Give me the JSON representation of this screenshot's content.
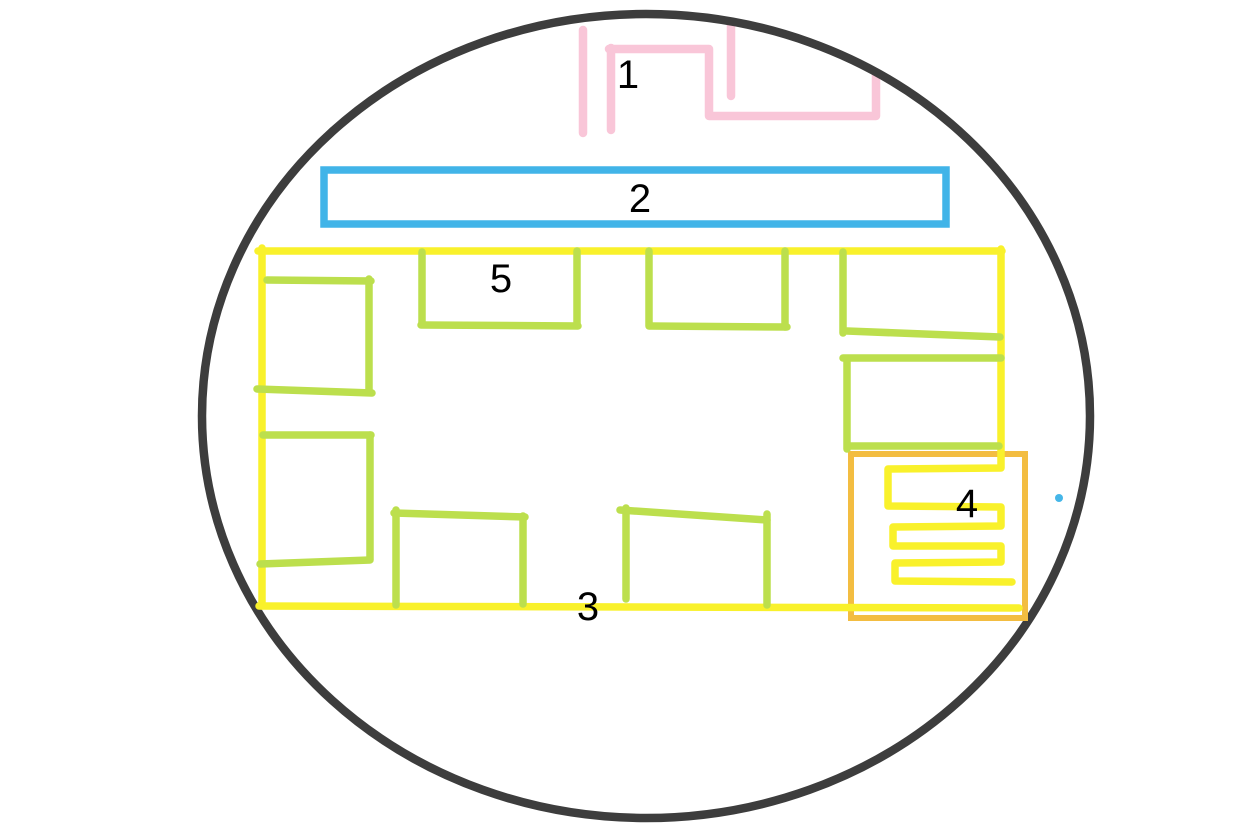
{
  "canvas": {
    "width": 1236,
    "height": 837,
    "background": "#ffffff"
  },
  "palette": {
    "outline_gray": "#3d3d3d",
    "pink": "#f9c6d8",
    "blue": "#41b4e8",
    "yellow": "#f9f12b",
    "green": "#bcdf4d",
    "orange": "#f3bd41",
    "dot_blue": "#45b6e8",
    "label_color": "#000000"
  },
  "labels": [
    {
      "id": "1",
      "text": "1",
      "x": 628,
      "y": 75
    },
    {
      "id": "2",
      "text": "2",
      "x": 640,
      "y": 199
    },
    {
      "id": "3",
      "text": "3",
      "x": 588,
      "y": 607
    },
    {
      "id": "4",
      "text": "4",
      "x": 967,
      "y": 504
    },
    {
      "id": "5",
      "text": "5",
      "x": 501,
      "y": 279
    }
  ],
  "shapes": {
    "boundary_circle": {
      "cx": 646,
      "cy": 416,
      "rx": 444,
      "ry": 402,
      "stroke_width": 8.5
    },
    "pink_shape_1": {
      "stroke_width": 8.5,
      "strokes": [
        [
          [
            583,
            30
          ],
          [
            583,
            133
          ]
        ],
        [
          [
            611,
            48
          ],
          [
            611,
            130
          ]
        ],
        [
          [
            609,
            49
          ],
          [
            709,
            49
          ],
          [
            709,
            116
          ],
          [
            876,
            116
          ],
          [
            876,
            74
          ]
        ],
        [
          [
            731,
            24
          ],
          [
            731,
            96
          ]
        ]
      ]
    },
    "blue_rect_2": {
      "x": 324,
      "y": 170,
      "width": 622,
      "height": 54,
      "stroke_width": 7.5
    },
    "orange_rect_4": {
      "x": 851,
      "y": 454,
      "width": 174,
      "height": 164,
      "stroke_width": 6
    },
    "yellow_room_3": {
      "stroke_width": 7.5,
      "strokes": {
        "left_wall": [
          [
            262,
            248
          ],
          [
            262,
            606
          ]
        ],
        "top_wall": [
          [
            258,
            251
          ],
          [
            1002,
            251
          ]
        ],
        "right_wall_and_coil": [
          [
            1001,
            249
          ],
          [
            1001,
            468
          ],
          [
            888,
            469
          ],
          [
            888,
            506
          ],
          [
            1001,
            507
          ],
          [
            1001,
            526
          ],
          [
            893,
            527
          ],
          [
            893,
            546
          ],
          [
            1001,
            546
          ],
          [
            1001,
            562
          ],
          [
            895,
            563
          ],
          [
            895,
            581
          ],
          [
            1012,
            582
          ]
        ],
        "bottom_wall": [
          [
            259,
            606
          ],
          [
            1019,
            608
          ]
        ]
      }
    },
    "green_boxes": [
      {
        "name": "green-box-left-upper",
        "strokes": [
          [
            [
              267,
              280
            ],
            [
              371,
              281
            ]
          ],
          [
            [
              369,
              279
            ],
            [
              369,
              391
            ]
          ],
          [
            [
              257,
              389
            ],
            [
              372,
              393
            ]
          ]
        ]
      },
      {
        "name": "green-box-left-lower",
        "strokes": [
          [
            [
              263,
              435
            ],
            [
              371,
              435
            ]
          ],
          [
            [
              370,
              435
            ],
            [
              370,
              559
            ]
          ],
          [
            [
              260,
              564
            ],
            [
              370,
              560
            ]
          ]
        ]
      },
      {
        "name": "green-box-top-1",
        "strokes": [
          [
            [
              422,
              252
            ],
            [
              422,
              324
            ]
          ],
          [
            [
              421,
              325
            ],
            [
              578,
              326
            ]
          ],
          [
            [
              577,
              251
            ],
            [
              577,
              324
            ]
          ]
        ]
      },
      {
        "name": "green-box-top-2",
        "strokes": [
          [
            [
              649,
              251
            ],
            [
              649,
              326
            ]
          ],
          [
            [
              650,
              326
            ],
            [
              787,
              327
            ]
          ],
          [
            [
              785,
              251
            ],
            [
              785,
              327
            ]
          ]
        ]
      },
      {
        "name": "green-box-top-right",
        "strokes": [
          [
            [
              843,
              252
            ],
            [
              843,
              333
            ]
          ],
          [
            [
              847,
              331
            ],
            [
              1000,
              337
            ]
          ]
        ]
      },
      {
        "name": "green-box-right-middle",
        "strokes": [
          [
            [
              843,
              358
            ],
            [
              1001,
              358
            ]
          ],
          [
            [
              847,
              359
            ],
            [
              847,
              449
            ]
          ],
          [
            [
              849,
              446
            ],
            [
              999,
              446
            ]
          ]
        ]
      },
      {
        "name": "green-box-bottom-1",
        "strokes": [
          [
            [
              396,
              510
            ],
            [
              396,
              605
            ]
          ],
          [
            [
              394,
              513
            ],
            [
              525,
              517
            ]
          ],
          [
            [
              523,
              516
            ],
            [
              523,
              604
            ]
          ]
        ]
      },
      {
        "name": "green-box-bottom-2",
        "strokes": [
          [
            [
              626,
              508
            ],
            [
              626,
              599
            ]
          ],
          [
            [
              620,
              510
            ],
            [
              767,
              520
            ]
          ],
          [
            [
              767,
              514
            ],
            [
              767,
              605
            ]
          ]
        ]
      }
    ],
    "blue_dot": {
      "cx": 1059,
      "cy": 498,
      "r": 4
    }
  }
}
